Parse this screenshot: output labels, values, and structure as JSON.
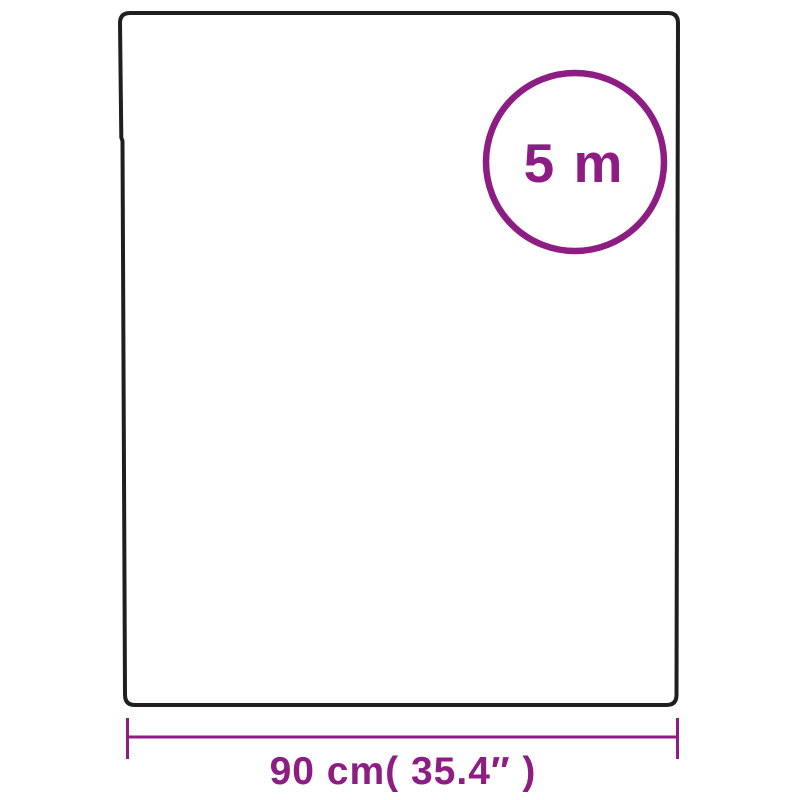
{
  "diagram": {
    "roll_length_badge": {
      "label": "5 m"
    },
    "width_dimension": {
      "label": "90 cm( 35.4″ )"
    },
    "colors": {
      "background": "#ffffff",
      "outline": "#1f1f1f",
      "accent": "#8e1d83"
    }
  }
}
